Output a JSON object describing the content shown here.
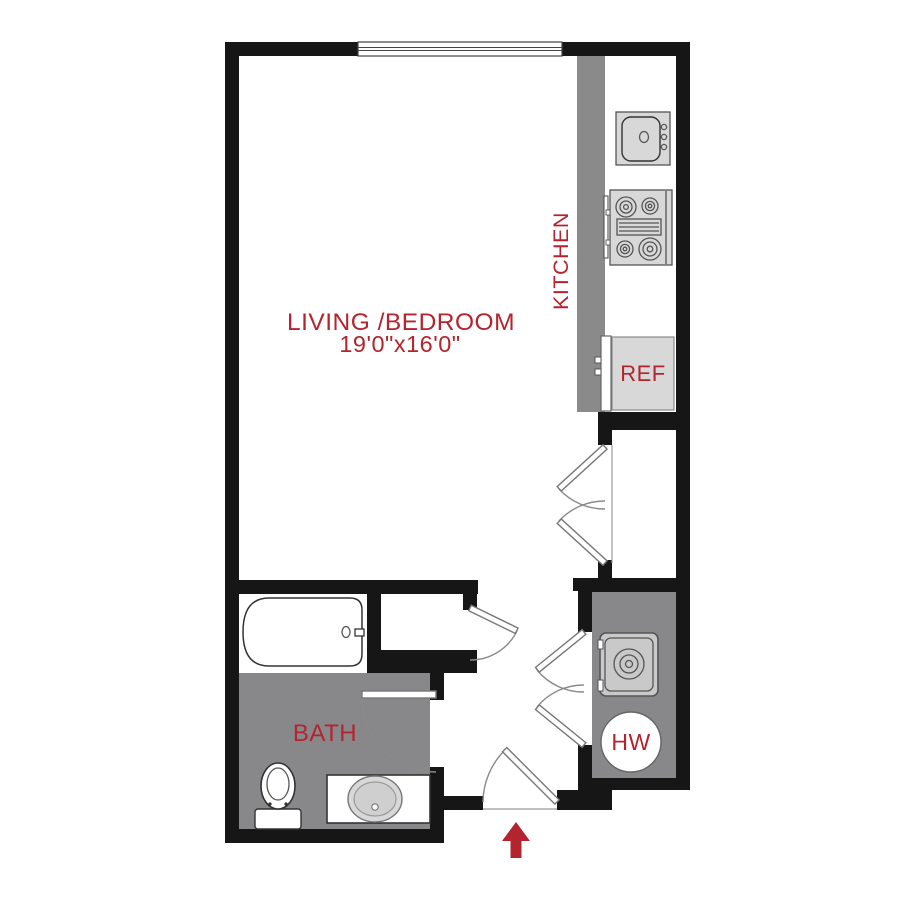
{
  "labels": {
    "living_bedroom": "LIVING /BEDROOM",
    "living_dims": "19'0\"x16'0\"",
    "kitchen": "KITCHEN",
    "ref": "REF",
    "bath": "BATH",
    "hw": "HW"
  },
  "fixtures": [
    "window",
    "kitchen-sink",
    "stove",
    "refrigerator",
    "closet-double-doors",
    "utility-double-doors",
    "washer",
    "water-heater",
    "bathtub",
    "toilet",
    "vanity-sink",
    "entry-door",
    "entry-arrow"
  ],
  "colors": {
    "wall": "#161616",
    "accent_red": "#b3242e",
    "floor_gray": "#88888b",
    "counter_gray": "#8a8a8a",
    "fixture_gray": "#d8d8d8",
    "appliance_gray": "#c9c9c9",
    "outline": "#555555"
  }
}
